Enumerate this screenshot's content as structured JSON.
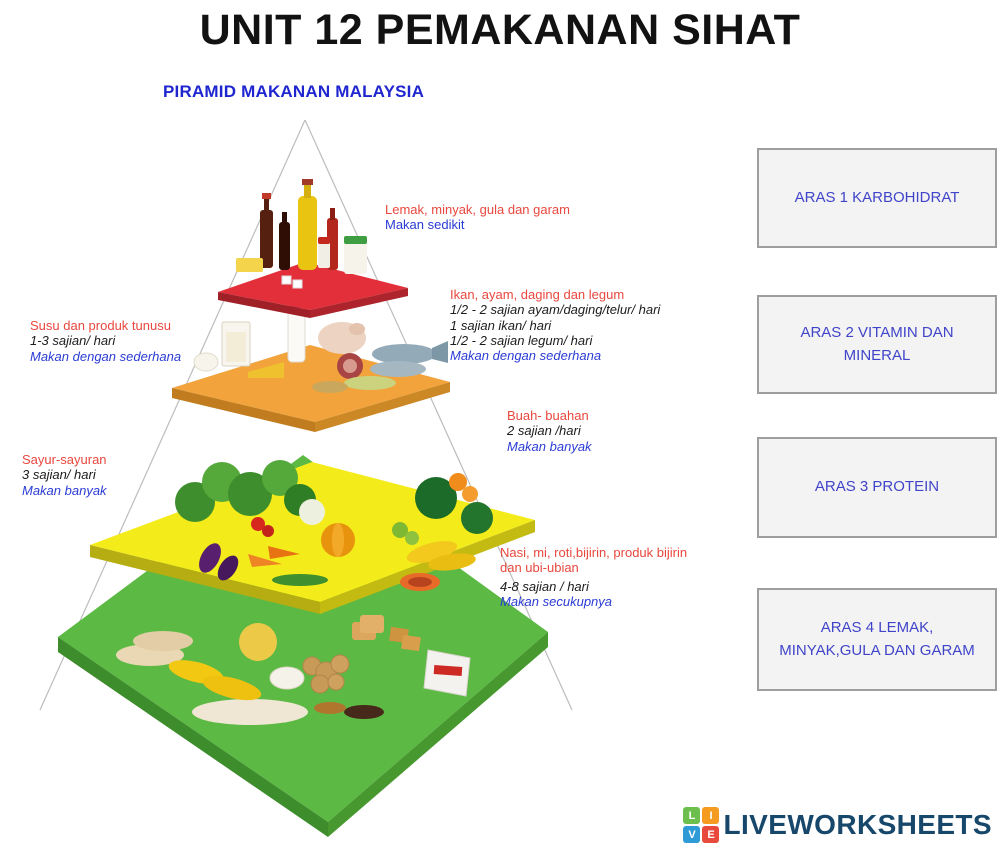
{
  "page": {
    "title": "UNIT 12 PEMAKANAN SIHAT"
  },
  "pyramid": {
    "heading": "PIRAMID MAKANAN MALAYSIA",
    "labels": [
      {
        "name": "fats",
        "title": "Lemak, minyak, gula dan garam",
        "servings": [],
        "advice": "Makan sedikit",
        "foods": [
          "oil-bottle",
          "sauce-bottles",
          "butter",
          "salt-jar",
          "sugar-cubes"
        ]
      },
      {
        "name": "meat-fish-legumes",
        "title": "Ikan, ayam, daging dan legum",
        "servings": [
          "1/2 - 2 sajian ayam/daging/telur/ hari",
          "1 sajian ikan/ hari",
          "1/2 - 2 sajian legum/ hari"
        ],
        "advice": "Makan dengan sederhana",
        "foods": [
          "milk-glass",
          "milk-bottle",
          "cheese",
          "chicken",
          "meat",
          "fish",
          "legumes"
        ]
      },
      {
        "name": "dairy",
        "title": "Susu dan produk tunusu",
        "servings": [
          "1-3 sajian/ hari"
        ],
        "advice": "Makan dengan sederhana",
        "foods": [
          "milk",
          "yogurt",
          "cheese"
        ]
      },
      {
        "name": "fruits",
        "title": "Buah- buahan",
        "servings": [
          "2 sajian /hari"
        ],
        "advice": "Makan banyak",
        "foods": [
          "watermelon",
          "oranges",
          "bananas",
          "papaya"
        ]
      },
      {
        "name": "vegetables",
        "title": "Sayur-sayuran",
        "servings": [
          "3 sajian/ hari"
        ],
        "advice": "Makan banyak",
        "foods": [
          "leafy-greens",
          "tomatoes",
          "carrots",
          "eggplant",
          "pumpkin",
          "beans"
        ]
      },
      {
        "name": "grains",
        "title": "Nasi, mi, roti,bijirin, produk bijirin dan ubi-ubian",
        "servings": [
          "4-8 sajian / hari"
        ],
        "advice": "Makan secukupnya",
        "foods": [
          "flatbread",
          "corn",
          "noodles",
          "potatoes",
          "rice",
          "bread",
          "crackers",
          "flour-sack"
        ]
      }
    ],
    "level_colors": {
      "fats": "#e22f3a",
      "protein": "#f2a33c",
      "vitamins": "#f4ec1a",
      "carbs": "#5cb944"
    }
  },
  "answer_boxes": [
    {
      "label": "ARAS 1 KARBOHIDRAT"
    },
    {
      "label": "ARAS 2 VITAMIN DAN MINERAL"
    },
    {
      "label": "ARAS 3 PROTEIN"
    },
    {
      "label": "ARAS 4 LEMAK, MINYAK,GULA DAN GARAM"
    }
  ],
  "footer": {
    "logo_text": "LIVEWORKSHEETS",
    "logo_squares": [
      {
        "letter": "L",
        "color": "#6cbf4c"
      },
      {
        "letter": "I",
        "color": "#f59b20"
      },
      {
        "letter": "V",
        "color": "#2e9bd6"
      },
      {
        "letter": "E",
        "color": "#e84b3c"
      }
    ],
    "logo_text_color": "#17486b"
  },
  "colors": {
    "title": "#121212",
    "heading_blue": "#1f25cf",
    "label_red": "#e8483e",
    "label_blue": "#2a3bd4",
    "box_text_blue": "#4044c9",
    "box_background": "#f3f3f3",
    "box_border": "#9e9e9e"
  }
}
